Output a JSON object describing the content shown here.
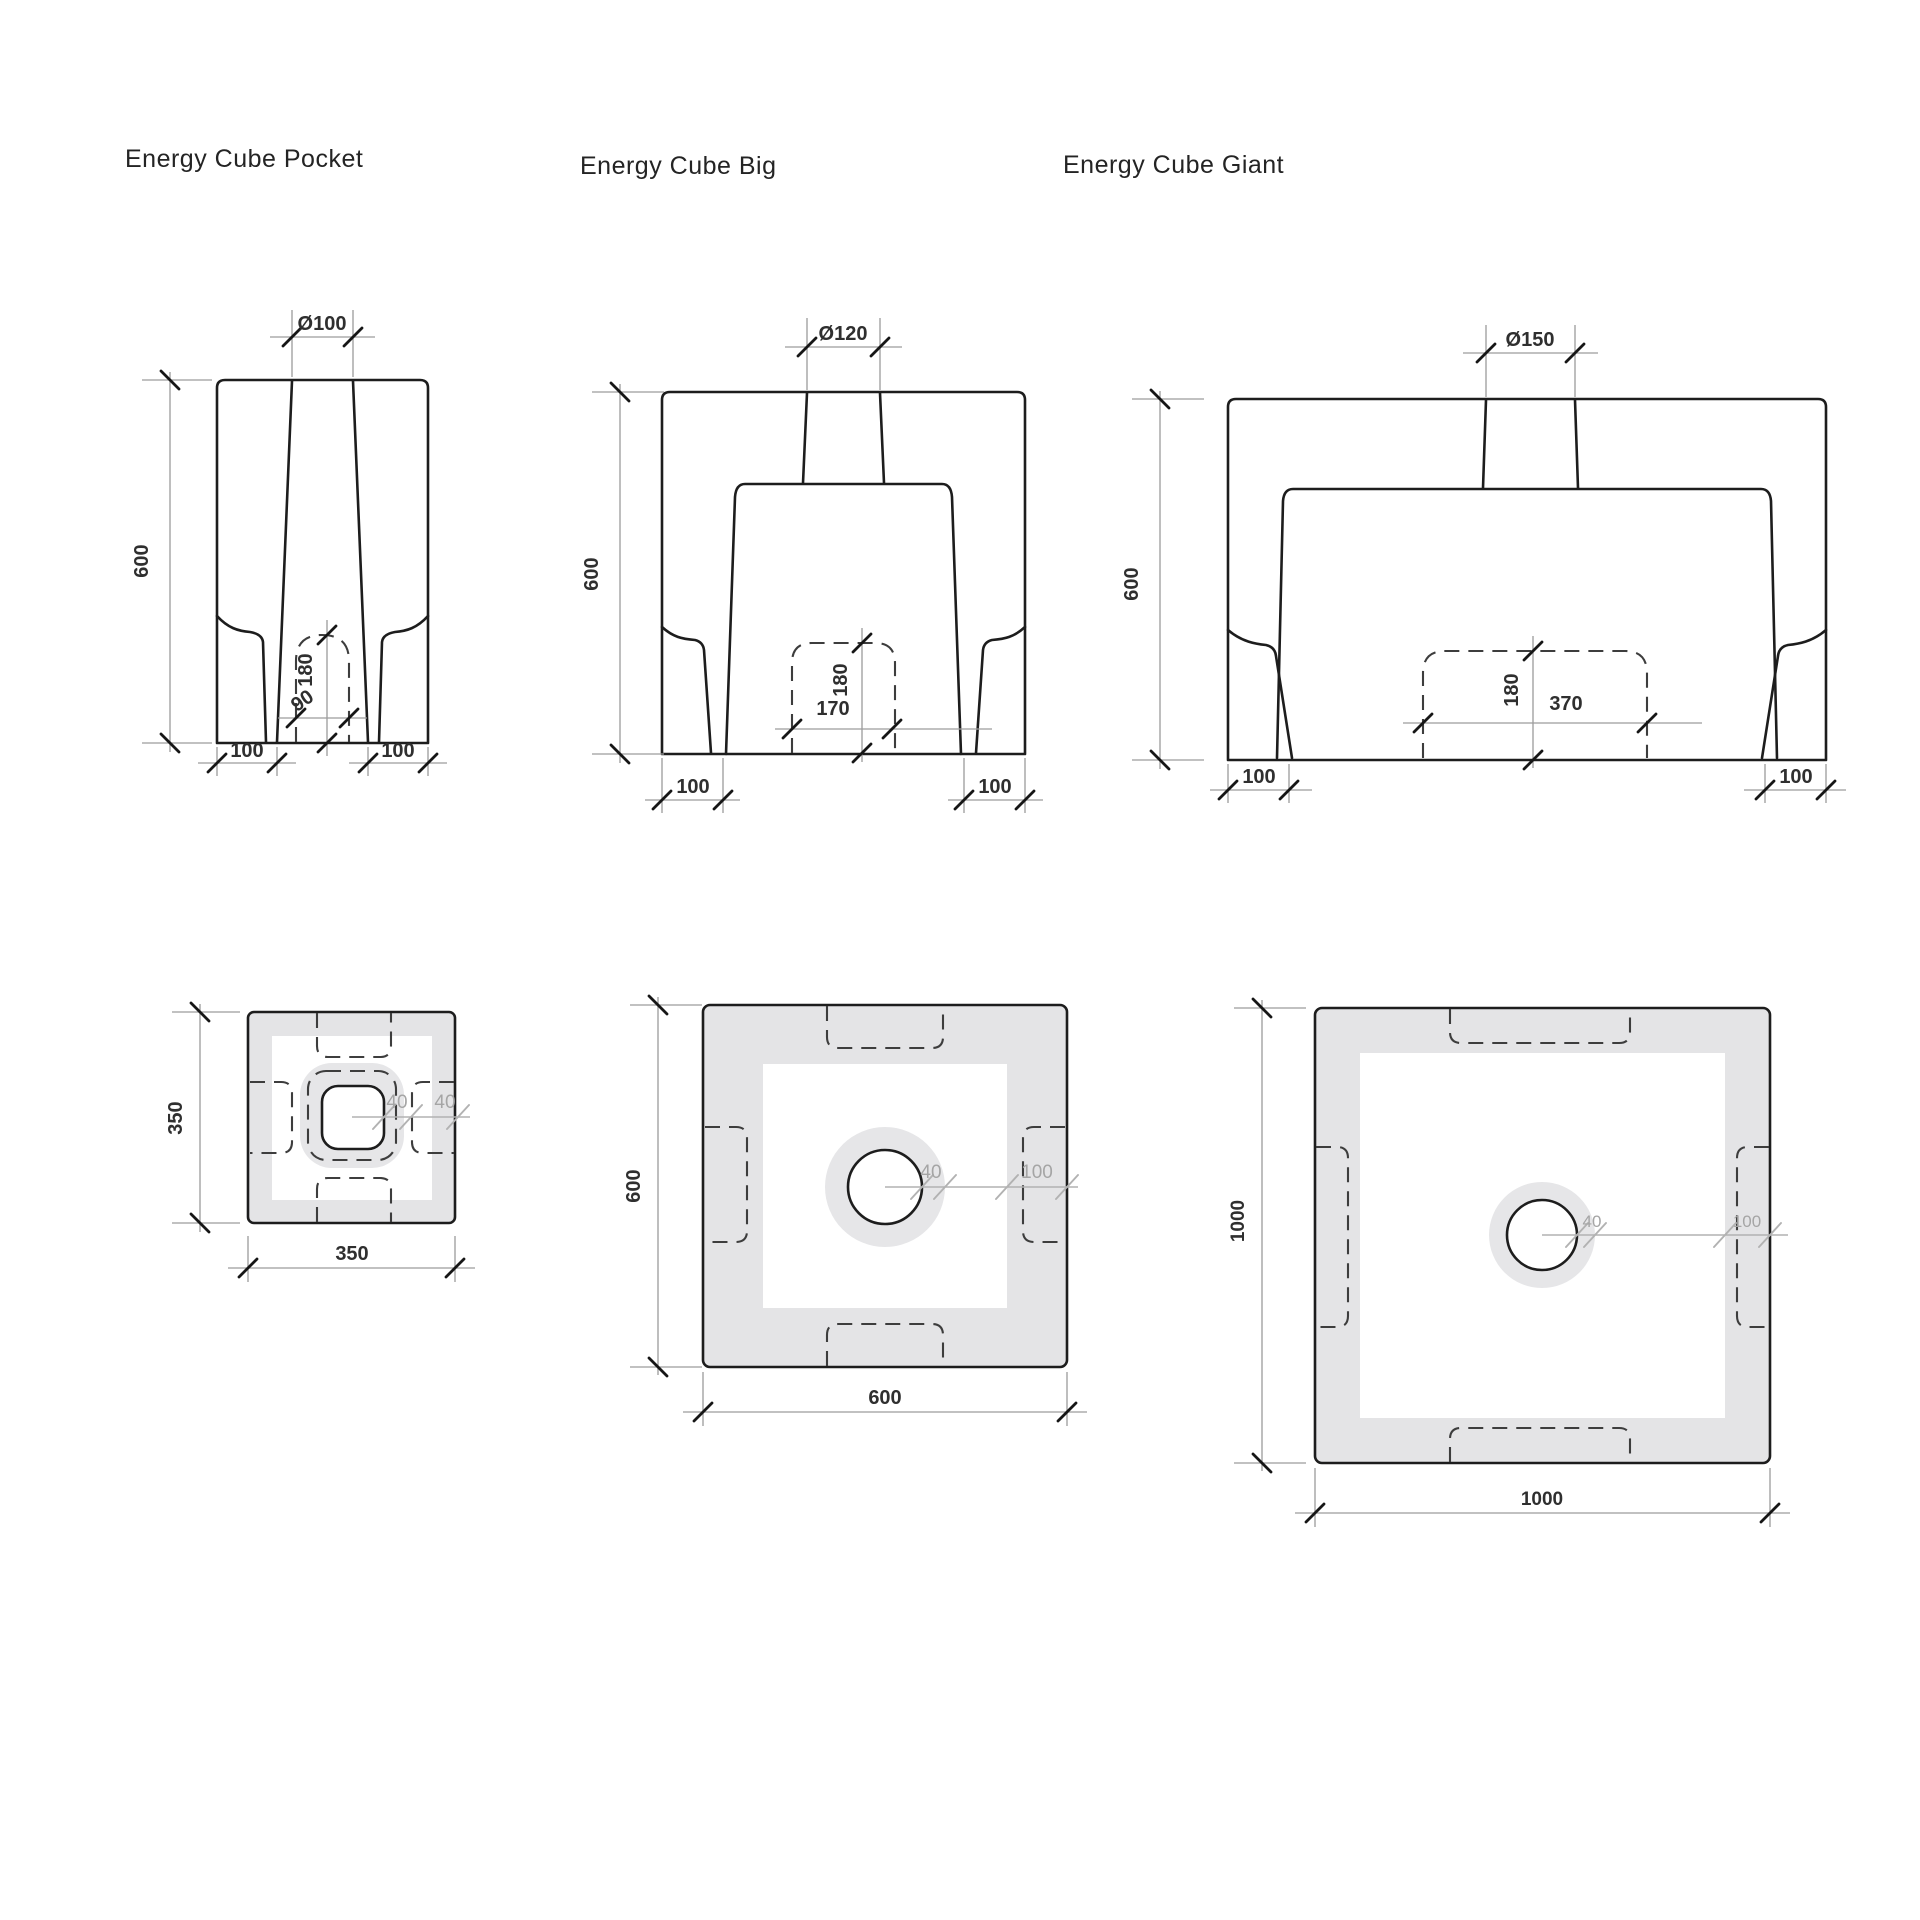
{
  "titles": {
    "pocket": "Energy Cube Pocket",
    "big": "Energy Cube Big",
    "giant": "Energy Cube Giant"
  },
  "pocket": {
    "elevation": {
      "diameter": "Ø100",
      "height": "600",
      "cavity_height": "180",
      "cavity_width": "90",
      "foot_left": "100",
      "foot_right": "100"
    },
    "plan": {
      "side_vertical": "350",
      "side_horizontal": "350",
      "offset_inner": "40",
      "offset_outer": "40"
    }
  },
  "big": {
    "elevation": {
      "diameter": "Ø120",
      "height": "600",
      "cavity_height": "180",
      "cavity_width": "170",
      "foot_left": "100",
      "foot_right": "100"
    },
    "plan": {
      "side_vertical": "600",
      "side_horizontal": "600",
      "hole_ring": "40",
      "wall_thickness": "100"
    }
  },
  "giant": {
    "elevation": {
      "diameter": "Ø150",
      "height": "600",
      "cavity_height": "180",
      "cavity_width": "370",
      "foot_left": "100",
      "foot_right": "100"
    },
    "plan": {
      "side_vertical": "1000",
      "side_horizontal": "1000",
      "hole_ring": "40",
      "wall_thickness": "100"
    }
  },
  "colors": {
    "background": "#ffffff",
    "outline": "#1d1d1d",
    "hidden_line": "#3d3d3d",
    "dimension_line": "#9c9c9c",
    "fill_gray": "#e4e4e6",
    "gray_dimension": "#b2b2b2",
    "label": "#2f2f2f",
    "gray_label": "#a5a5a5"
  }
}
